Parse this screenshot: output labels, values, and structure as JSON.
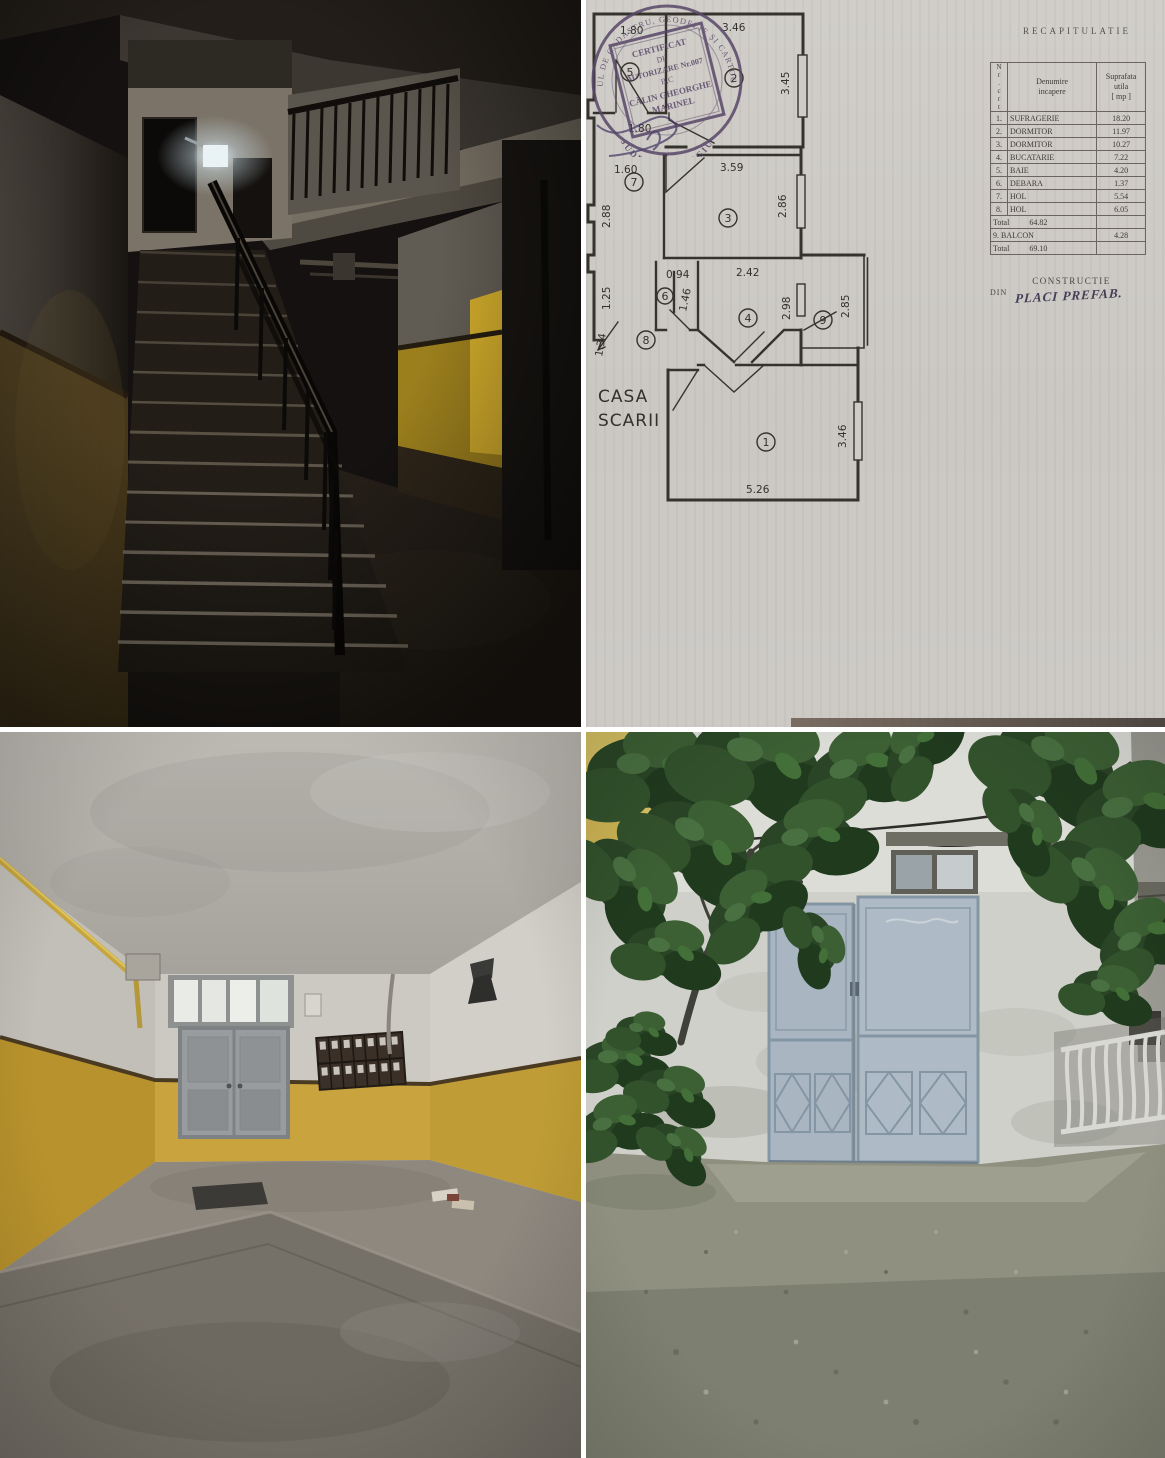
{
  "colors": {
    "paper": "#cfccc8",
    "plan_ink": "#36332d",
    "stamp_ink": "#584768",
    "wainscot_yellow": "#c8a13b",
    "trim_brown": "#4a3a22",
    "gate_blue": "#a9b6c1",
    "foliage_green": "#2a4526",
    "asphalt": "#8f9080"
  },
  "floor_plan": {
    "title": "RECAPITULATIE",
    "table": {
      "header": {
        "nr": "N\nr\n.\nc\nr\nt",
        "name": "Denumire\nincapere",
        "area": "Suprafata\nutila\n[ mp ]"
      },
      "rows": [
        {
          "nr": "1.",
          "name": "SUFRAGERIE",
          "area": "18.20"
        },
        {
          "nr": "2.",
          "name": "DORMITOR",
          "area": "11.97"
        },
        {
          "nr": "3.",
          "name": "DORMITOR",
          "area": "10.27"
        },
        {
          "nr": "4.",
          "name": "BUCATARIE",
          "area": "7.22"
        },
        {
          "nr": "5.",
          "name": "BAIE",
          "area": "4.20"
        },
        {
          "nr": "6.",
          "name": "DEBARA",
          "area": "1.37"
        },
        {
          "nr": "7.",
          "name": "HOL",
          "area": "5.54"
        },
        {
          "nr": "8.",
          "name": "HOL",
          "area": "6.05"
        }
      ],
      "subtotal": {
        "label": "Total",
        "value": "64.82"
      },
      "balcony": {
        "nr": "9.",
        "name": "BALCON",
        "area": "4.28"
      },
      "total": {
        "label": "Total",
        "value": "69.10"
      }
    },
    "construction": {
      "title": "CONSTRUCTIE",
      "prefix": "DIN",
      "value": "PLACI PREFAB."
    },
    "plan": {
      "casa_line1": "CASA",
      "casa_line2": "SCARII",
      "rooms": [
        "1",
        "2",
        "3",
        "4",
        "5",
        "6",
        "7",
        "8",
        "9"
      ],
      "dims": {
        "w5": "1.80",
        "w2": "3.46",
        "h2": "3.45",
        "w5b": "1.80",
        "w7": "1.60",
        "h7": "2.88",
        "w3": "3.59",
        "h3": "2.86",
        "h125": "1.25",
        "w6": "0.94",
        "h6": "1.46",
        "w4": "2.42",
        "h4": "2.98",
        "h9": "2.85",
        "h134": "1.34",
        "w1": "5.26",
        "h1": "3.46"
      }
    },
    "stamp": {
      "ring_top": "OFICIUL DE CADASTRU, GEODEZIE ȘI CARTOGRAFIE",
      "ring_bottom": "JUDEȚUL GIURGIU",
      "cert": [
        "CERTIFICAT",
        "DE",
        "AUTORIZARE Nr.007",
        "B,C",
        "CĂLIN GHEORGHE",
        "MARINEL"
      ]
    }
  }
}
